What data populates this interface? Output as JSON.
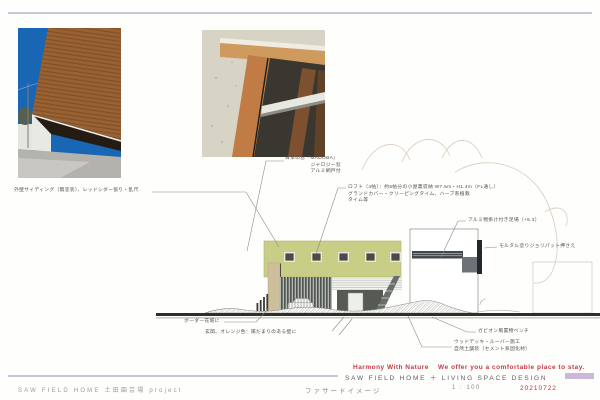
{
  "header": {
    "top_rule_color": "#cfc3da"
  },
  "photos": {
    "exterior_label": "exterior-photo",
    "window_label": "window-detail-photo"
  },
  "annotations": {
    "siding": {
      "line1": "外壁サイディング（無塗装）、レッドシダー張り・乱尺"
    },
    "madoba": {
      "line1": "日本の窓『MADOBA』",
      "line2": "ジャロジー窓",
      "line3": "アルミ網戸付"
    },
    "loft": {
      "line1": "ロフト（4帖）：約5帖分の小屋裏収納 W7.5m・H1.4m（FL通し）",
      "line2": "グランドカバー・クリーピングタイム、ハーブ系植栽",
      "line3": "タイム等"
    },
    "alumi": {
      "line1": "アルミ物掛け付き足場（+5.3）"
    },
    "mortar": {
      "line1": "モルタル塗りジョリパット押さえ"
    },
    "gabion": {
      "line1": "ガビオン風置物ベンチ"
    },
    "wooddeck": {
      "line1": "ウッドデッキ・ルーバー施工",
      "line2": "自然土舗装（セメント系固化材）"
    },
    "border": {
      "line1": "ボーダー花壇に"
    },
    "entrance": {
      "line1": "玄関、オレンジ色：陽だまりのある壁に"
    }
  },
  "footer": {
    "project_left": "SAW FIELD HOME 土田園芸場 project",
    "drawing_title": "ファサードイメージ",
    "tagline1": "Harmony With Nature",
    "tagline2": "We offer you a comfortable place to stay.",
    "brand": "SAW FIELD HOME ＋ LIVING SPACE DESIGN",
    "scale_label": "1 : 100",
    "date": "20210722"
  },
  "colors": {
    "accent_red": "#c43a44",
    "lavender": "#c9b8d6",
    "olive_band": "#c9ce87",
    "ground_line": "#2f2f2a"
  }
}
